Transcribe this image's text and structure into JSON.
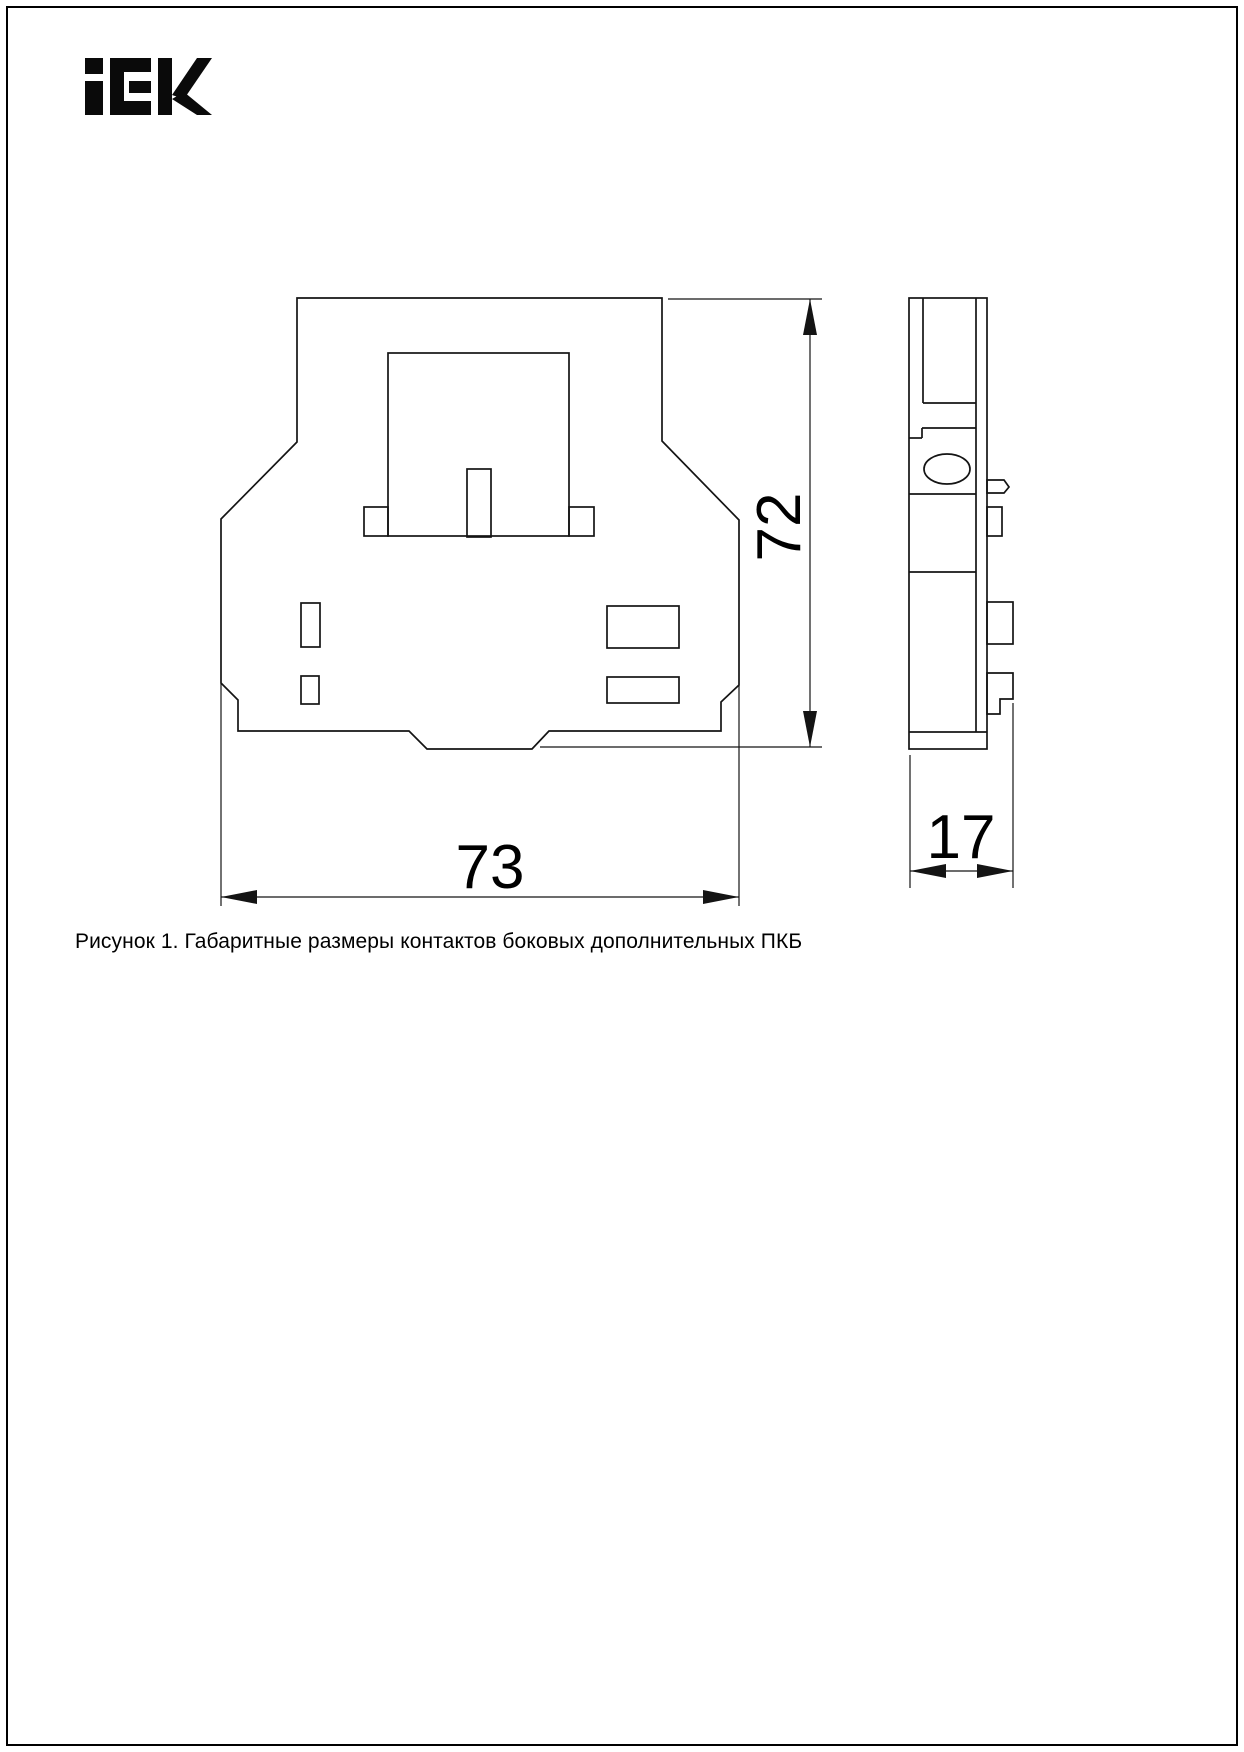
{
  "page": {
    "background": "#ffffff",
    "border_color": "#000000"
  },
  "logo": {
    "brand": "IEK"
  },
  "figure": {
    "caption": "Рисунок 1. Габаритные размеры контактов боковых дополнительных ПКБ",
    "dimensions": {
      "width_mm": "73",
      "height_mm": "72",
      "depth_mm": "17"
    },
    "views": {
      "front": "front-view-outline",
      "side": "side-view-outline"
    }
  },
  "colors": {
    "line": "#141414",
    "text": "#000000"
  }
}
